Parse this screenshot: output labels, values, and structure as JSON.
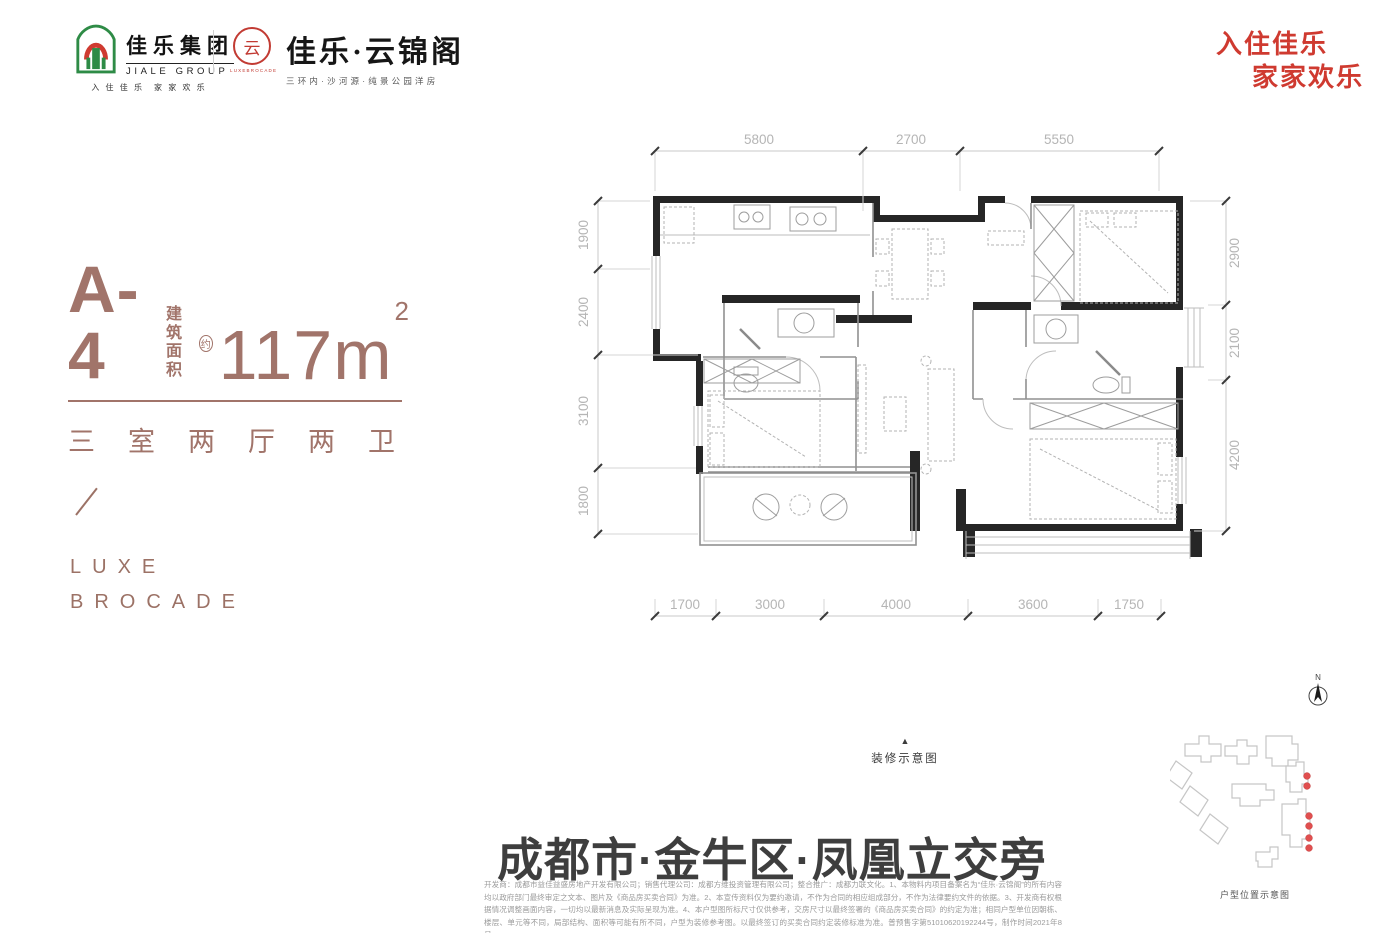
{
  "header": {
    "group": {
      "name_cn": "佳乐集团",
      "name_en": "JIALE GROUP",
      "tagline": "入 住 佳 乐　家 家 欢 乐"
    },
    "brand": {
      "seal_char": "云",
      "seal_caption": "LUXEBROCADE",
      "name": "佳乐·云锦阁",
      "tagline": "三环内·沙河源·纯景公园洋房"
    },
    "slogan_line1": "入住佳乐",
    "slogan_line2": "家家欢乐"
  },
  "unit": {
    "code": "A-4",
    "area_label_line1": "建筑",
    "area_label_line2": "面积",
    "area_approx": "约",
    "area_value": "117m",
    "area_sup": "2",
    "rooms": "三室两厅两卫",
    "luxe_line1": "LUXE",
    "luxe_line2": "BROCADE"
  },
  "plan": {
    "caption_arrow": "▲",
    "caption": "装修示意图",
    "dims_top": [
      "5800",
      "2700",
      "5550"
    ],
    "dims_left": [
      "1900",
      "2400",
      "3100",
      "1800"
    ],
    "dims_right": [
      "2900",
      "2100",
      "4200"
    ],
    "dims_bottom": [
      "1700",
      "3000",
      "4000",
      "3600",
      "1750"
    ]
  },
  "location_banner": "成都市·金牛区·凤凰立交旁",
  "disclaimer": {
    "text": "开发商：成都市益佳益盛房地产开发有限公司；销售代理公司：成都方维投资管理有限公司；整合推广：成都力联文化。1、本物料内项目备案名为“佳乐·云锦阁”的所有内容均以政府部门最终审定之文本、图片及《商品房买卖合同》为准。2、本宣传资料仅为要约邀请，不作为合同的相应组成部分，不作为法律要约文件的依据。3、开发商有权根据情况调整画面内容，一切均以最新消息及实际呈现为准。4、本户型图所标尺寸仅供参考，交房尺寸以最终签署的《商品房买卖合同》的约定为准；相同户型单位因朝栋、楼层、单元等不同，局部结构、面积等可能有所不同，户型为装修参考图。以最终签订的买卖合同约定装修标准为准。普预售字第51010620192244号，制作时间2021年8月。"
  },
  "site_map": {
    "north_label": "N",
    "caption": "户型位置示意图"
  }
}
